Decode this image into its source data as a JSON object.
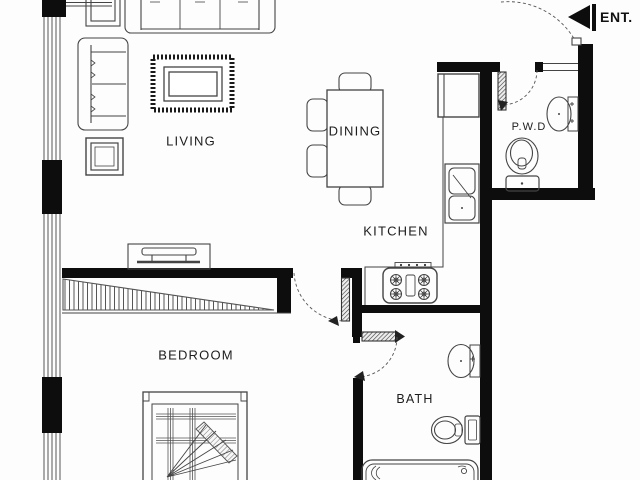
{
  "plan": {
    "labels": {
      "entrance": "ENT.",
      "living": "LIVING",
      "dining": "DINING",
      "kitchen": "KITCHEN",
      "powder_room": "P.W.D",
      "bedroom": "BEDROOM",
      "bath": "BATH"
    },
    "colors": {
      "background": "#fdfdfd",
      "wall": "#0d0d0d",
      "line": "#444444",
      "text": "#1d1d1d"
    },
    "rooms": [
      {
        "name": "LIVING",
        "items": [
          "three-seat-sofa",
          "two-seat-sofa",
          "corner-table",
          "side-table",
          "rug",
          "coffee-table",
          "tv-console"
        ]
      },
      {
        "name": "DINING",
        "items": [
          "dining-table",
          "dining-chair",
          "dining-chair",
          "dining-chair",
          "dining-chair"
        ]
      },
      {
        "name": "KITCHEN",
        "items": [
          "refrigerator",
          "counter",
          "double-basin-sink",
          "four-burner-cooktop"
        ]
      },
      {
        "name": "P.W.D",
        "items": [
          "wash-basin",
          "toilet"
        ]
      },
      {
        "name": "BEDROOM",
        "items": [
          "wardrobe",
          "double-bed"
        ]
      },
      {
        "name": "BATH",
        "items": [
          "wash-basin",
          "toilet",
          "bathtub"
        ]
      }
    ],
    "doors": [
      "entrance-door",
      "powder-room-door",
      "bedroom-door",
      "bath-door"
    ],
    "windows": [
      "left-window-wall"
    ]
  }
}
